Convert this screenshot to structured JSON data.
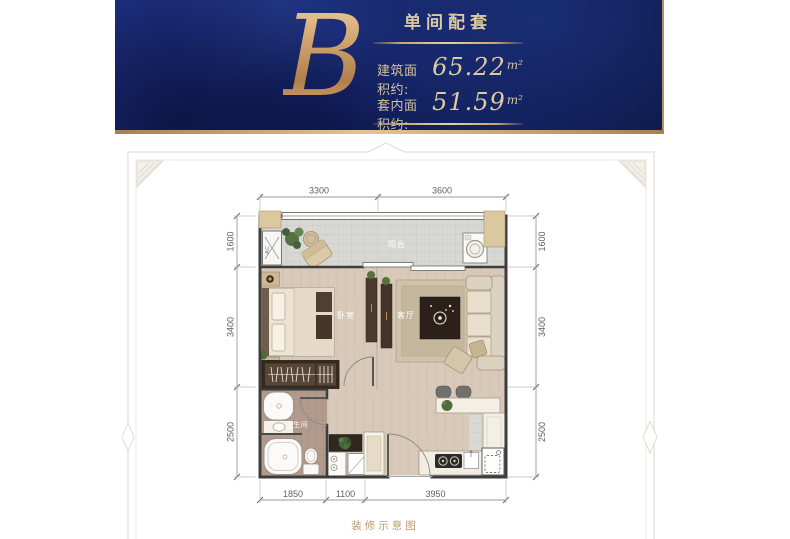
{
  "header": {
    "unit_letter": "B",
    "title": "单间配套",
    "rows": [
      {
        "label": "建筑面积约:",
        "value": "65.22",
        "unit": "m²"
      },
      {
        "label": "套内面积约:",
        "value": "51.59",
        "unit": "m²"
      }
    ]
  },
  "plan": {
    "labels": {
      "balcony": "阳台",
      "bedroom": "卧室",
      "living_room": "客厅",
      "bathroom": "卫生间",
      "ac": "AC"
    },
    "dims": {
      "top": [
        "3300",
        "3600"
      ],
      "bottom": [
        "1850",
        "1100",
        "3950"
      ],
      "left": [
        "1600",
        "3400",
        "2500"
      ],
      "right": [
        "1600",
        "3400",
        "2500"
      ]
    }
  },
  "footer": {
    "caption": "装修示意图"
  },
  "colors": {
    "banner_blue": "#13215f",
    "gold_accent": "#c9a06a",
    "caption_gold": "#bb9a6f",
    "wall": "#3d3d3d",
    "wood_floor": "#d8c9b9",
    "balcony_tile": "#d7d7d3",
    "bathroom_tile": "#b29a8c",
    "column": "#dbc8a0"
  }
}
